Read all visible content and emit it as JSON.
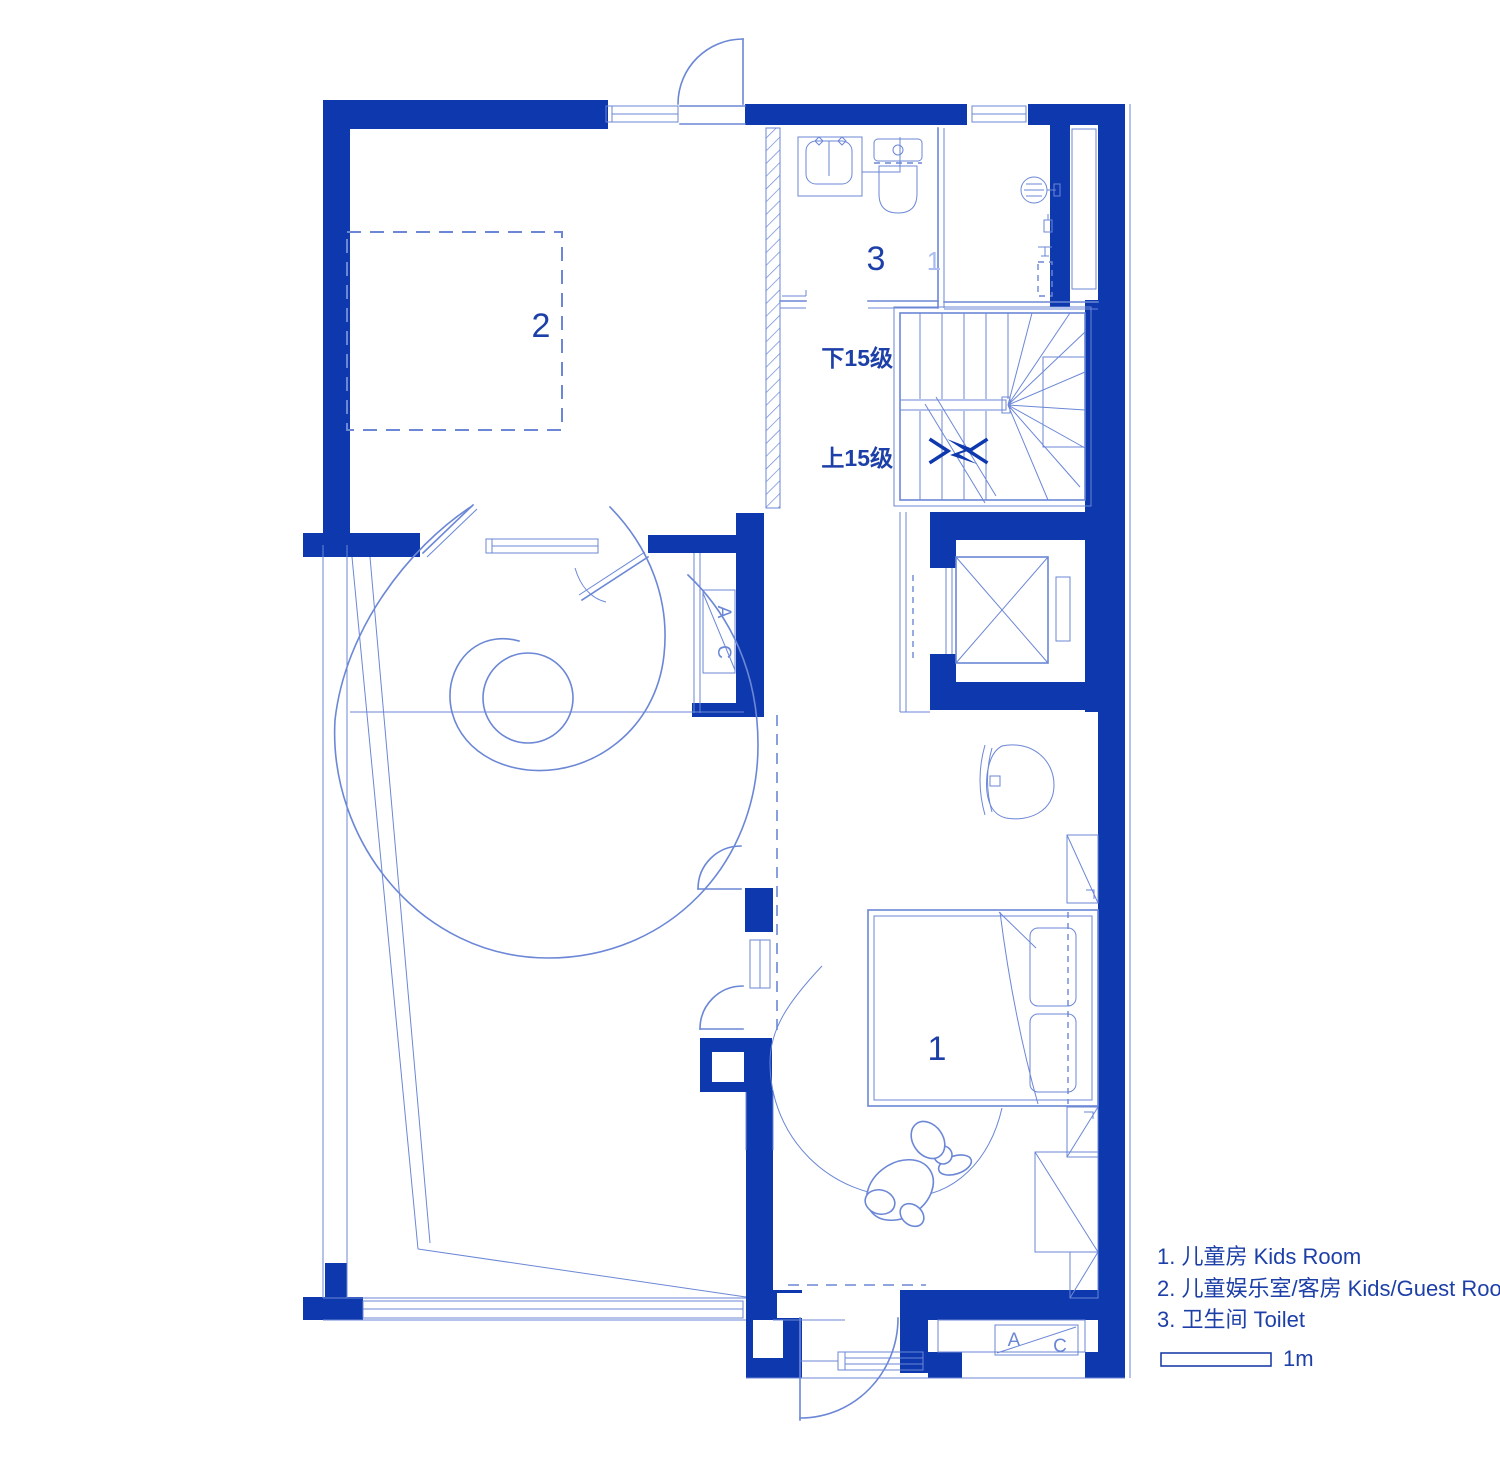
{
  "colors": {
    "wall": "#0e38ae",
    "line": "#6b87d6",
    "text": "#1d3fa8",
    "bg": "#ffffff"
  },
  "rooms": {
    "room1_number": "1",
    "room2_number": "2",
    "room3_number": "3",
    "shower_faint_number": "1"
  },
  "stairs": {
    "down_label": "下15级",
    "up_label": "上15级"
  },
  "ac_unit": {
    "a": "A",
    "c": "C"
  },
  "legend": {
    "items": [
      "1. 儿童房  Kids Room",
      "2. 儿童娱乐室/客房  Kids/Guest Room",
      "3. 卫生间  Toilet"
    ],
    "scale_label": "1m"
  }
}
